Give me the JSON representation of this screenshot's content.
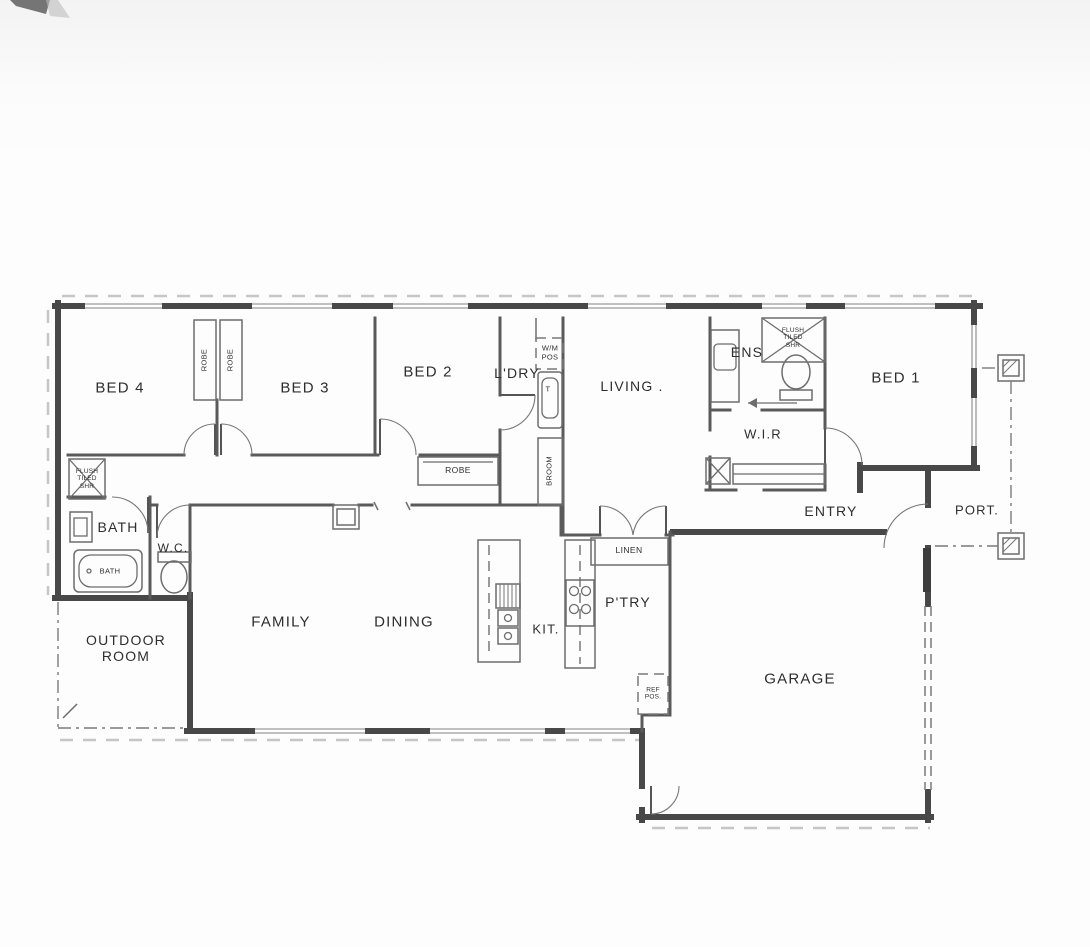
{
  "document": {
    "type": "scanned-floor-plan",
    "paper_color": "#fdfdfd",
    "line_color": "#4a4a4a"
  },
  "rooms": {
    "bed4": "BED 4",
    "bed3": "BED 3",
    "bed2": "BED 2",
    "ldry": "L'DRY",
    "living": "LIVING .",
    "ens": "ENS",
    "bed1": "BED 1",
    "wir": "W.I.R",
    "bath": "BATH",
    "wc": "W.C.",
    "outdoor": "OUTDOOR\nROOM",
    "family": "FAMILY",
    "dining": "DINING",
    "kit": "KIT.",
    "ptry": "P'TRY",
    "entry": "ENTRY",
    "port": "PORT.",
    "garage": "GARAGE"
  },
  "fixtures": {
    "robe_left": "ROBE",
    "robe_right": "ROBE",
    "robe_bed2": "ROBE",
    "wm_pos": "W/M\nPOS",
    "trough": "T",
    "broom": "BROOM",
    "linen": "LINEN",
    "ref_pos": "REF\nPOS.",
    "bath_tub": "BATH",
    "shower_bath": "FLUSH\nTILED\nSHR",
    "shower_ens": "FLUSH\nTILED\nSHR"
  }
}
